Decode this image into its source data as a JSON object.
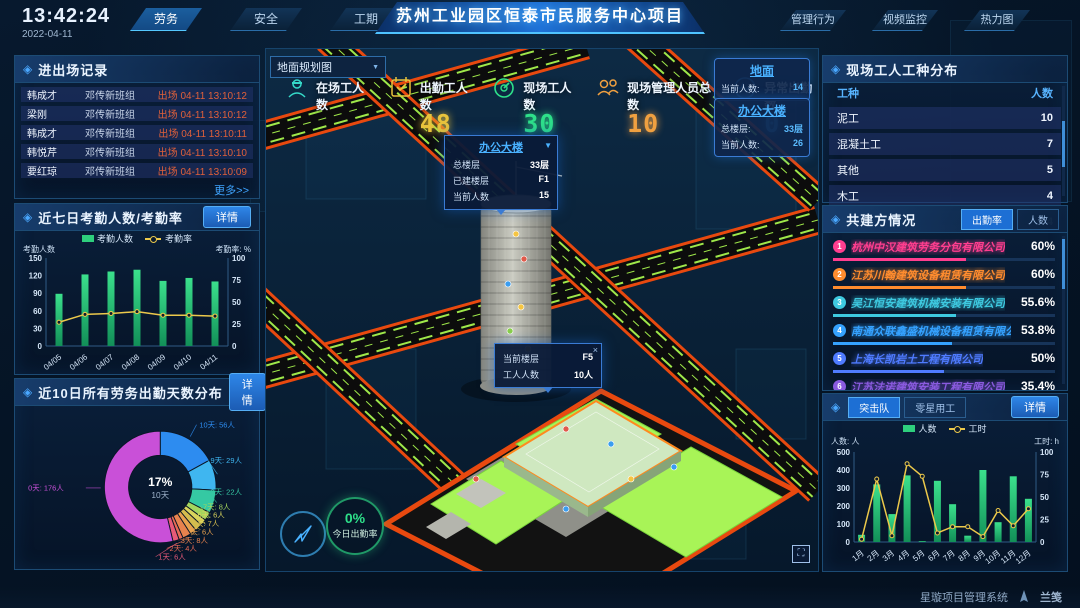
{
  "topbar": {
    "time": "13:42:24",
    "date": "2022-04-11",
    "left_tabs": [
      {
        "label": "劳务",
        "active": true
      },
      {
        "label": "安全",
        "active": false
      },
      {
        "label": "工期",
        "active": false
      }
    ],
    "title": "苏州工业园区恒泰市民服务中心项目",
    "right_tabs": [
      {
        "label": "管理行为",
        "active": false
      },
      {
        "label": "视频监控",
        "active": false
      },
      {
        "label": "热力图",
        "active": false
      }
    ]
  },
  "entry_exit": {
    "title": "进出场记录",
    "more_label": "更多>>",
    "rows": [
      {
        "name": "韩成才",
        "team": "邓传新班组",
        "event": "出场 04-11 13:10:12"
      },
      {
        "name": "梁刚",
        "team": "邓传新班组",
        "event": "出场 04-11 13:10:12"
      },
      {
        "name": "韩成才",
        "team": "邓传新班组",
        "event": "出场 04-11 13:10:11"
      },
      {
        "name": "韩悦芹",
        "team": "邓传新班组",
        "event": "出场 04-11 13:10:10"
      },
      {
        "name": "要红琼",
        "team": "邓传新班组",
        "event": "出场 04-11 13:10:09"
      }
    ]
  },
  "attendance": {
    "title": "近七日考勤人数/考勤率",
    "detail_label": "详情",
    "legend": [
      "考勤人数",
      "考勤率"
    ],
    "axis_left": "考勤人数",
    "axis_right": "考勤率: %",
    "chart": {
      "type": "bar+line",
      "categories": [
        "04/05",
        "04/06",
        "04/07",
        "04/08",
        "04/09",
        "04/10",
        "04/11"
      ],
      "bars": [
        89,
        122,
        127,
        130,
        111,
        116,
        110
      ],
      "line": [
        27,
        36,
        37,
        39,
        35,
        35,
        34
      ],
      "left_max": 150,
      "left_ticks": [
        0,
        30,
        60,
        90,
        120,
        150
      ],
      "right_max": 100,
      "right_ticks": [
        0,
        25,
        50,
        75,
        100
      ]
    }
  },
  "distribution": {
    "title": "近10日所有劳务出勤天数分布",
    "detail_label": "详情",
    "center_pct": "17%",
    "center_label": "10天",
    "chart": {
      "type": "donut",
      "unit": "人",
      "slices": [
        {
          "label": "10天",
          "value": 56,
          "color": "#2d8cf0"
        },
        {
          "label": "9天",
          "value": 29,
          "color": "#3fb6f0"
        },
        {
          "label": "8天",
          "value": 22,
          "color": "#35c9a3"
        },
        {
          "label": "7天",
          "value": 8,
          "color": "#a4d65e"
        },
        {
          "label": "6天",
          "value": 6,
          "color": "#d9d45c"
        },
        {
          "label": "5天",
          "value": 7,
          "color": "#d4bc4e"
        },
        {
          "label": "4天",
          "value": 6,
          "color": "#e8a14e"
        },
        {
          "label": "3天",
          "value": 8,
          "color": "#e8834e"
        },
        {
          "label": "2天",
          "value": 4,
          "color": "#e86a55"
        },
        {
          "label": "1天",
          "value": 6,
          "color": "#e85a78"
        },
        {
          "label": "0天",
          "value": 176,
          "color": "#c950d8"
        }
      ]
    }
  },
  "map": {
    "dropdown_label": "地面规划图",
    "stats": [
      {
        "label": "在场工人数",
        "value": "",
        "color": "#35d9c8",
        "icon": "worker-icon"
      },
      {
        "label": "出勤工人数",
        "value": "48",
        "color": "#e8c33c",
        "icon": "calendar-check-icon"
      },
      {
        "label": "现场工人数",
        "value": "30",
        "color": "#2ee08a",
        "icon": "gauge-icon"
      },
      {
        "label": "现场管理人员总数",
        "value": "10",
        "color": "#f0a040",
        "icon": "people-icon"
      },
      {
        "label": "异常出勤数",
        "value": "0",
        "color": "#35a2ff",
        "icon": "pulse-icon"
      }
    ],
    "cards": [
      {
        "title": "地面",
        "lines": [
          {
            "k": "当前人数:",
            "v": "14"
          }
        ]
      },
      {
        "title": "办公大楼",
        "lines": [
          {
            "k": "总楼层:",
            "v": "33层"
          },
          {
            "k": "当前人数:",
            "v": "26"
          }
        ]
      }
    ],
    "building_tooltip": {
      "title": "办公大楼",
      "rows": [
        {
          "k": "总楼层",
          "v": "33层"
        },
        {
          "k": "已建楼层",
          "v": "F1"
        },
        {
          "k": "当前人数",
          "v": "15"
        }
      ]
    },
    "floor_tooltip": {
      "close": "×",
      "rows": [
        {
          "k": "当前楼层",
          "v": "F5"
        },
        {
          "k": "工人人数",
          "v": "10人"
        }
      ]
    },
    "gauge": {
      "value": "0%",
      "label": "今日出勤率"
    }
  },
  "worker_types": {
    "title": "现场工人工种分布",
    "headers": [
      "工种",
      "人数"
    ],
    "rows": [
      {
        "type": "泥工",
        "count": "10"
      },
      {
        "type": "混凝土工",
        "count": "7"
      },
      {
        "type": "其他",
        "count": "5"
      },
      {
        "type": "木工",
        "count": "4"
      },
      {
        "type": "塔司",
        "count": "4"
      }
    ]
  },
  "partners": {
    "title": "共建方情况",
    "tabs": [
      {
        "label": "出勤率",
        "active": true
      },
      {
        "label": "人数",
        "active": false
      }
    ],
    "items": [
      {
        "rank": "1",
        "name": "杭州中汉建筑劳务分包有限公司",
        "value": "60%",
        "pct": 60,
        "color": "#ff3e8f"
      },
      {
        "rank": "2",
        "name": "江苏川翰建筑设备租赁有限公司",
        "value": "60%",
        "pct": 60,
        "color": "#ff8c2e"
      },
      {
        "rank": "3",
        "name": "吴江恒安建筑机械安装有限公司",
        "value": "55.6%",
        "pct": 55.6,
        "color": "#3ec9e0"
      },
      {
        "rank": "4",
        "name": "南通众联鑫盛机械设备租赁有限公司",
        "value": "53.8%",
        "pct": 53.8,
        "color": "#35a2ff"
      },
      {
        "rank": "5",
        "name": "上海长凯岩土工程有限公司",
        "value": "50%",
        "pct": 50,
        "color": "#4f7bff"
      },
      {
        "rank": "6",
        "name": "江苏法诺建筑安装工程有限公司",
        "value": "35.4%",
        "pct": 35.4,
        "color": "#8a5adf"
      }
    ]
  },
  "squad": {
    "tabs": [
      {
        "label": "突击队",
        "active": true
      },
      {
        "label": "零星用工",
        "active": false
      }
    ],
    "detail_label": "详情",
    "legend": [
      "人数",
      "工时"
    ],
    "axis_left": "人数: 人",
    "axis_right": "工时: h",
    "chart": {
      "type": "bar+line",
      "categories": [
        "1月",
        "2月",
        "3月",
        "4月",
        "5月",
        "6月",
        "7月",
        "8月",
        "9月",
        "10月",
        "11月",
        "12月"
      ],
      "bars": [
        40,
        320,
        155,
        370,
        5,
        340,
        210,
        35,
        400,
        110,
        365,
        240
      ],
      "line": [
        3,
        70,
        7,
        87,
        73,
        10,
        17,
        17,
        6,
        35,
        18,
        37
      ],
      "left_max": 500,
      "left_ticks": [
        0,
        100,
        200,
        300,
        400,
        500
      ],
      "right_max": 100,
      "right_ticks": [
        0,
        25,
        50,
        75,
        100
      ]
    }
  },
  "footer": {
    "brand": "星璇项目管理系统",
    "logo": "兰笺"
  }
}
